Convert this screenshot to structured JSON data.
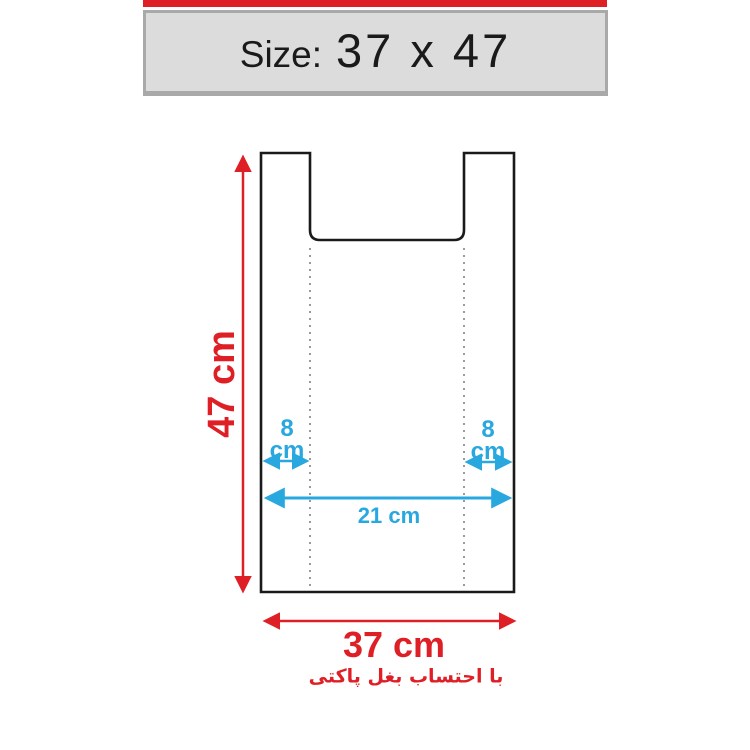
{
  "header": {
    "size_label": "Size:",
    "size_value": "37 x 47"
  },
  "diagram": {
    "height_label": "47 cm",
    "width_label": "37 cm",
    "inner_width_label": "21 cm",
    "left_gusset": {
      "value": "8",
      "unit": "cm"
    },
    "right_gusset": {
      "value": "8",
      "unit": "cm"
    },
    "footnote": "با احتساب بغل پاکتی"
  },
  "colors": {
    "accent_red": "#df1f26",
    "accent_blue": "#29a8e0",
    "outline_dark": "#1a1a1a"
  }
}
